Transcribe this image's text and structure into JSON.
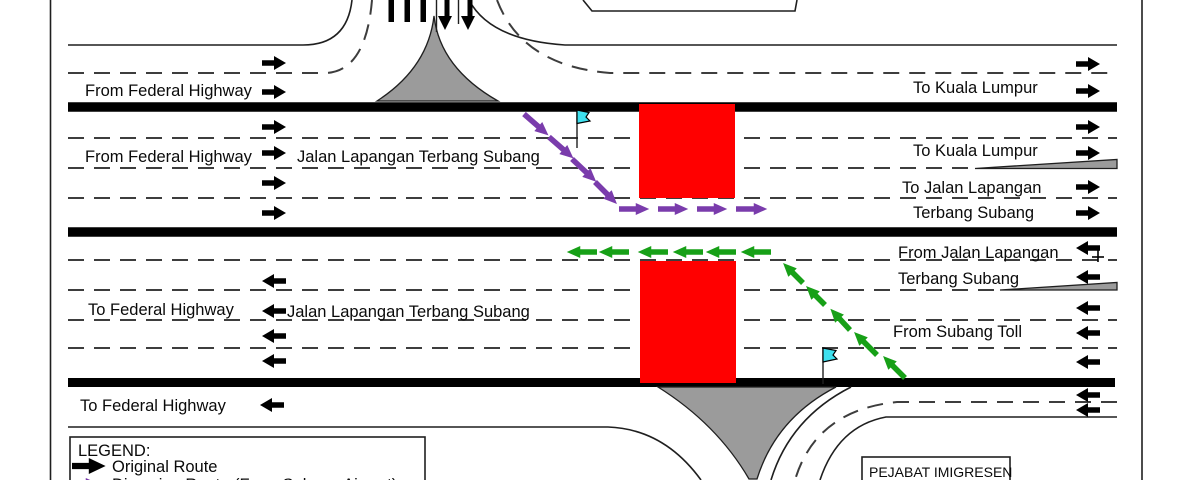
{
  "roads": {
    "a": {
      "left": "From Federal Highway",
      "right": "To Kuala Lumpur"
    },
    "b": {
      "left": "From Federal Highway",
      "center": "Jalan Lapangan Terbang Subang",
      "right1": "To Kuala Lumpur",
      "right2": "To Jalan Lapangan",
      "right3": "Terbang Subang"
    },
    "c": {
      "left": "To Federal Highway",
      "center": "Jalan Lapangan Terbang Subang",
      "right1": "From Jalan Lapangan",
      "right2": "Terbang Subang",
      "right3": "From Subang Toll"
    },
    "d": {
      "left": "To Federal Highway"
    }
  },
  "building": {
    "label": "PEJABAT IMIGRESEN"
  },
  "legend": {
    "title": "LEGEND:",
    "item1": "Original Route",
    "item2": "Diversion Route (From Subang Airport)"
  },
  "colors": {
    "closure_red": "#FF0000",
    "diversion_purple": "#7A3CAC",
    "diversion_green": "#17A017",
    "flag_cyan": "#3EE0EE",
    "gore_gray": "#9B9B9B",
    "road_line": "#1F1F1F"
  }
}
